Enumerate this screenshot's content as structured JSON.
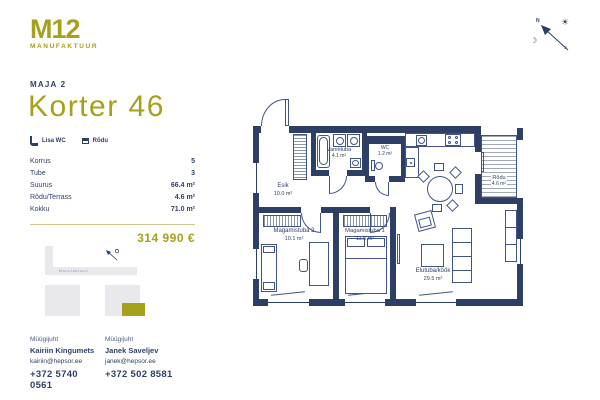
{
  "logo": {
    "brand": "M12",
    "sub": "MANUFAKTUUR"
  },
  "header": {
    "building": "MAJA 2",
    "title": "Korter 46"
  },
  "features": [
    {
      "icon": "wc-icon",
      "label": "Lisa WC"
    },
    {
      "icon": "balcony-icon",
      "label": "Rõdu"
    }
  ],
  "details": {
    "rows": [
      {
        "label": "Korrus",
        "value": "5"
      },
      {
        "label": "Tube",
        "value": "3"
      },
      {
        "label": "Suurus",
        "value": "66.4 m²"
      },
      {
        "label": "Rõdu/Terrass",
        "value": "4.6 m²"
      },
      {
        "label": "Kokku",
        "value": "71.0 m²"
      }
    ]
  },
  "price": "314 990 €",
  "site_map": {
    "street": "Manufaktuuri"
  },
  "compass": {
    "north": "N",
    "south": "S",
    "sun": "☀",
    "moon": "☽"
  },
  "floorplan": {
    "rooms": [
      {
        "name": "Esik",
        "area": "10.0 m²"
      },
      {
        "name": "Vannituba",
        "area": "4.1 m²"
      },
      {
        "name": "WC",
        "area": "1.2 m²"
      },
      {
        "name": "Rõdu",
        "area": "4.6 m²"
      },
      {
        "name": "Magamistuba 2",
        "area": "10.1 m²"
      },
      {
        "name": "Magamistuba 1",
        "area": "11.5 m²"
      },
      {
        "name": "Elutuba/köök",
        "area": "29.5 m²"
      }
    ]
  },
  "contacts": [
    {
      "role": "Müügijuht",
      "name": "Kairiin Kingumets",
      "email": "kairiin@hepsor.ee",
      "phone": "+372 5740 0561"
    },
    {
      "role": "Müügijuht",
      "name": "Janek Saveljev",
      "email": "janek@hepsor.ee",
      "phone": "+372 502 8581"
    }
  ],
  "colors": {
    "navy": "#2e3f66",
    "olive": "#a5a11d",
    "divider": "#cbc68e"
  }
}
